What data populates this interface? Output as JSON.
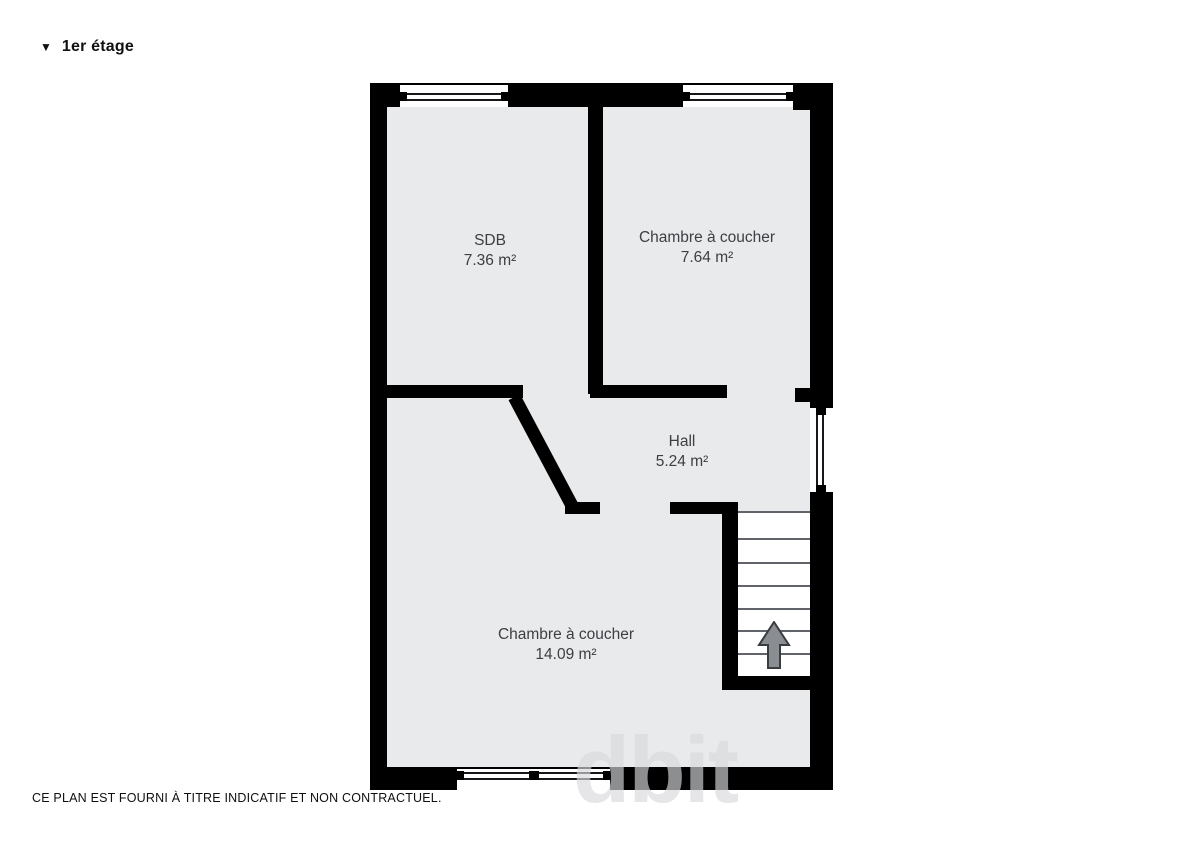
{
  "header": {
    "collapse_icon": "▼",
    "title": "1er étage"
  },
  "rooms": [
    {
      "name": "SDB",
      "area": "7.36 m²"
    },
    {
      "name": "Chambre à coucher",
      "area": "7.64 m²"
    },
    {
      "name": "Hall",
      "area": "5.24 m²"
    },
    {
      "name": "Chambre à coucher",
      "area": "14.09 m²"
    }
  ],
  "footer": {
    "disclaimer": "CE PLAN EST FOURNI À TITRE INDICATIF ET NON CONTRACTUEL."
  },
  "watermark": {
    "text": "dbit"
  },
  "colors": {
    "wall": "#000000",
    "floor": "#e8eaec",
    "label_text": "#3c4043",
    "stair_tread_line": "#60646a",
    "arrow_fill": "#8a8d91",
    "arrow_outline": "#3a3d40",
    "window_line": "#15171a"
  }
}
